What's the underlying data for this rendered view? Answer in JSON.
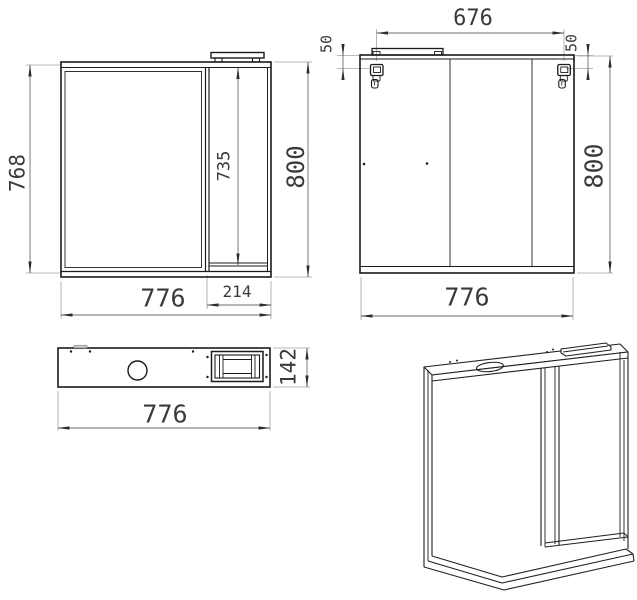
{
  "drawing": {
    "subject": "mirror-cabinet dimensional drawing",
    "colors": {
      "background": "#ffffff",
      "outline": "#1b1b1b",
      "dimension_line": "#6d6d6d",
      "extension_line": "#a3a3a3",
      "text": "#3a3a3a"
    },
    "views": {
      "front": {
        "label": "front view",
        "dims": {
          "height_left": "768",
          "door_height": "735",
          "height_overall": "800",
          "width_overall": "776",
          "door_width": "214"
        }
      },
      "rear": {
        "label": "rear view",
        "dims": {
          "hanger_span": "676",
          "hanger_offset_left": "50",
          "hanger_offset_right": "50",
          "height_overall": "800",
          "width_overall": "776"
        }
      },
      "top": {
        "label": "top view",
        "dims": {
          "width_overall": "776",
          "depth": "142"
        }
      },
      "iso": {
        "label": "isometric view"
      }
    }
  }
}
